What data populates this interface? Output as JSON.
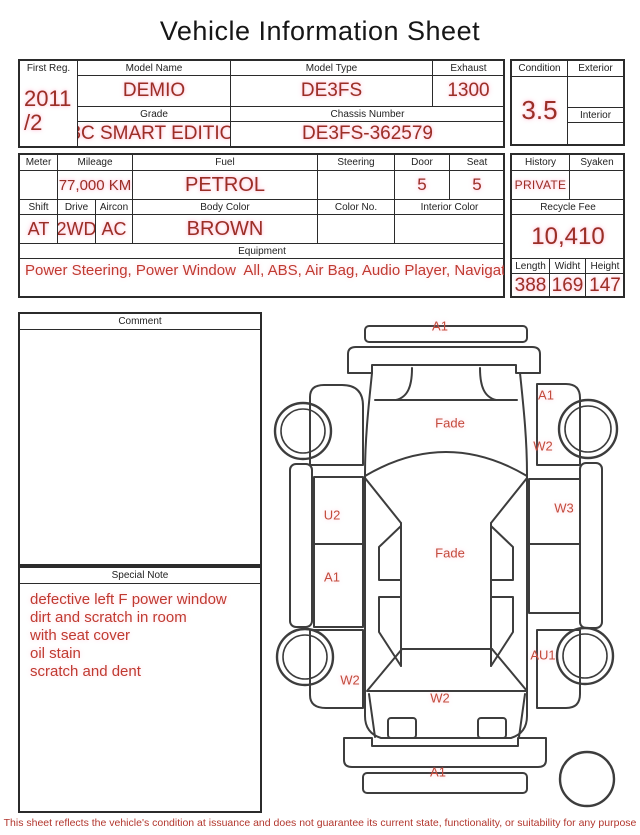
{
  "title": "Vehicle Information Sheet",
  "registration": {
    "first_reg": {
      "label": "First Reg.",
      "line1": "2011",
      "line2": "/2"
    },
    "model_name": {
      "label": "Model Name",
      "value": "DEMIO"
    },
    "model_type": {
      "label": "Model Type",
      "value": "DE3FS"
    },
    "exhaust": {
      "label": "Exhaust",
      "value": "1300"
    },
    "grade": {
      "label": "Grade",
      "value": "13C SMART EDITION"
    },
    "chassis_number": {
      "label": "Chassis Number",
      "value": "DE3FS-362579"
    }
  },
  "condition": {
    "condition": {
      "label": "Condition",
      "value": "3.5"
    },
    "exterior": {
      "label": "Exterior",
      "value": ""
    },
    "interior": {
      "label": "Interior",
      "value": ""
    }
  },
  "specs": {
    "meter": {
      "label": "Meter",
      "value": ""
    },
    "mileage": {
      "label": "Mileage",
      "value": "77,000 KM"
    },
    "fuel": {
      "label": "Fuel",
      "value": "PETROL"
    },
    "steering": {
      "label": "Steering",
      "value": ""
    },
    "door": {
      "label": "Door",
      "value": "5"
    },
    "seat": {
      "label": "Seat",
      "value": "5"
    },
    "shift": {
      "label": "Shift",
      "value": "AT"
    },
    "drive": {
      "label": "Drive",
      "value": "2WD"
    },
    "aircon": {
      "label": "Aircon",
      "value": "AC"
    },
    "body_color": {
      "label": "Body Color",
      "value": "BROWN"
    },
    "color_no": {
      "label": "Color No.",
      "value": ""
    },
    "interior_color": {
      "label": "Interior Color",
      "value": ""
    },
    "equipment": {
      "label": "Equipment",
      "value": "Power Steering, Power Window  All, ABS, Air Bag, Audio Player, Navigation System"
    }
  },
  "history": {
    "history": {
      "label": "History",
      "value": "PRIVATE"
    },
    "syaken": {
      "label": "Syaken",
      "value": ""
    },
    "recycle_fee": {
      "label": "Recycle Fee",
      "value": "10,410"
    },
    "length": {
      "label": "Length",
      "value": "388"
    },
    "width": {
      "label": "Widht",
      "value": "169"
    },
    "height": {
      "label": "Height",
      "value": "147"
    }
  },
  "comment": {
    "label": "Comment",
    "value": ""
  },
  "special_note": {
    "label": "Special Note",
    "lines": [
      "defective left F power window",
      "dirt and scratch in room",
      "with seat cover",
      "oil stain",
      "scratch and dent"
    ]
  },
  "diagram": {
    "labels": [
      {
        "part": "front-bumper",
        "text": "A1"
      },
      {
        "part": "hood",
        "text": "Fade"
      },
      {
        "part": "right-front-fender",
        "text": "A1"
      },
      {
        "part": "right-front-door",
        "text": "W2"
      },
      {
        "part": "right-rear-door",
        "text": "W3"
      },
      {
        "part": "left-front-door",
        "text": "U2"
      },
      {
        "part": "left-rear-door",
        "text": "A1"
      },
      {
        "part": "roof",
        "text": "Fade"
      },
      {
        "part": "left-rear-fender",
        "text": "W2"
      },
      {
        "part": "right-rear-fender",
        "text": "AU1"
      },
      {
        "part": "rear-window",
        "text": "W2"
      },
      {
        "part": "rear-bumper",
        "text": "A1"
      }
    ]
  },
  "footer": "This sheet reflects the vehicle's condition at issuance and does not guarantee its current state, functionality, or suitability for any purpose",
  "colors": {
    "value_red": "#9b2e26",
    "note_red": "#c03a30",
    "diagram_label_red": "#c44b3c",
    "line": "#2b2b2b"
  }
}
